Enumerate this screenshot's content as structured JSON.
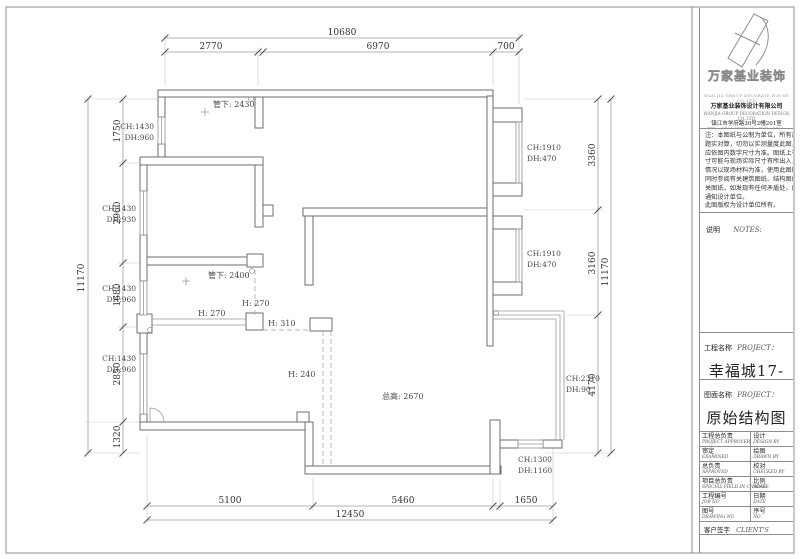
{
  "colors": {
    "wall_line": "#6e6e6e",
    "dim_line": "#9f9f9f",
    "text": "#333333",
    "beam_dash": "#b3b3b3"
  },
  "sheet": {
    "company": {
      "brand": "万家基业装饰",
      "brand_en": "WAN JIA GROUP DECORATE HOUSE CO.,LTD",
      "name": "万家基业装饰设计有限公司",
      "name_en": "WANJIA GROUP DECORATION DESIGN CO.,LTD",
      "address": "镇江市学府路30号2幢201室",
      "phone": "TEL：0511-8585188　FAX：0511-8585188"
    },
    "notes_lines": [
      "注：本图纸与公制为单位，所有尺寸间",
      "题实对算，切勿以实测量度此图，一切",
      "应依图内数字尺寸为准。图纸上有此尺",
      "寸可能与现场实际尺寸有所出入，遇此",
      "情况以现场材料为准，使用此图时，应",
      "同时参阅有关建筑图纸、结构图纸及有",
      "关图纸，如发现有任何矛盾处，应立即",
      "通知设计单位。",
      "此图版权为设计单位所有。"
    ],
    "shuoming": "说明",
    "notes_word": "NOTES:",
    "project_label": "工程名称",
    "project_en": "PROJECT：",
    "project_name": "幸福城17-403",
    "drawing_label": "图面名称",
    "drawing_en": "PROJECT：",
    "drawing_name": "原始结构图",
    "table": [
      {
        "zh": "工程总负责",
        "en": "PROJECT APPROVER",
        "zh2": "设计",
        "en2": "DESIGN BY"
      },
      {
        "zh": "审定",
        "en": "EXAMINED",
        "zh2": "绘图",
        "en2": "DRAWN BY"
      },
      {
        "zh": "总负责",
        "en": "APPROVED",
        "zh2": "校对",
        "en2": "CHECKED BY"
      },
      {
        "zh": "项目总负责",
        "en": "SPECIAL FIELD IN CHARGE",
        "zh2": "比例",
        "en2": "SCALE"
      },
      {
        "zh": "工程编号",
        "en": "JOB NO",
        "zh2": "日期",
        "en2": "DATE"
      },
      {
        "zh": "图号",
        "en": "DRAWING NO",
        "zh2": "序号",
        "en2": "NO."
      }
    ],
    "client": {
      "zh": "客户签字",
      "en": "CLIENT'S"
    }
  },
  "plan": {
    "dim_top_total": "10680",
    "dim_top": [
      "2770",
      "6970",
      "700"
    ],
    "dim_left_total": "11170",
    "dim_left": [
      "1750",
      "2960",
      "1680",
      "2850",
      "1320"
    ],
    "dim_right": [
      "3360",
      "3160",
      "4170"
    ],
    "dim_right_total": "11170",
    "dim_bottom": [
      "5100",
      "5460",
      "1650"
    ],
    "dim_bottom_total": "12450",
    "win_left": [
      [
        "CH:1430",
        "DH:960"
      ],
      [
        "CH:1430",
        "DH:930"
      ],
      [
        "CH:1430",
        "DH:960"
      ],
      [
        "CH:1430",
        "DH:960"
      ]
    ],
    "win_right": [
      [
        "CH:1910",
        "DH:470"
      ],
      [
        "CH:1910",
        "DH:470"
      ]
    ],
    "balcony": [
      "CH:2310",
      "DH:90"
    ],
    "win_bottom": [
      "CH:1300",
      "DH:1160"
    ],
    "labels": {
      "guanxia_a": "管下: 2430",
      "guanxia_b": "管下: 2400",
      "beam_v": "H: 270",
      "beam_h": "H: 270",
      "beam_h2": "H: 310",
      "beam_c": "H: 240",
      "height": "总高: 2670"
    }
  }
}
